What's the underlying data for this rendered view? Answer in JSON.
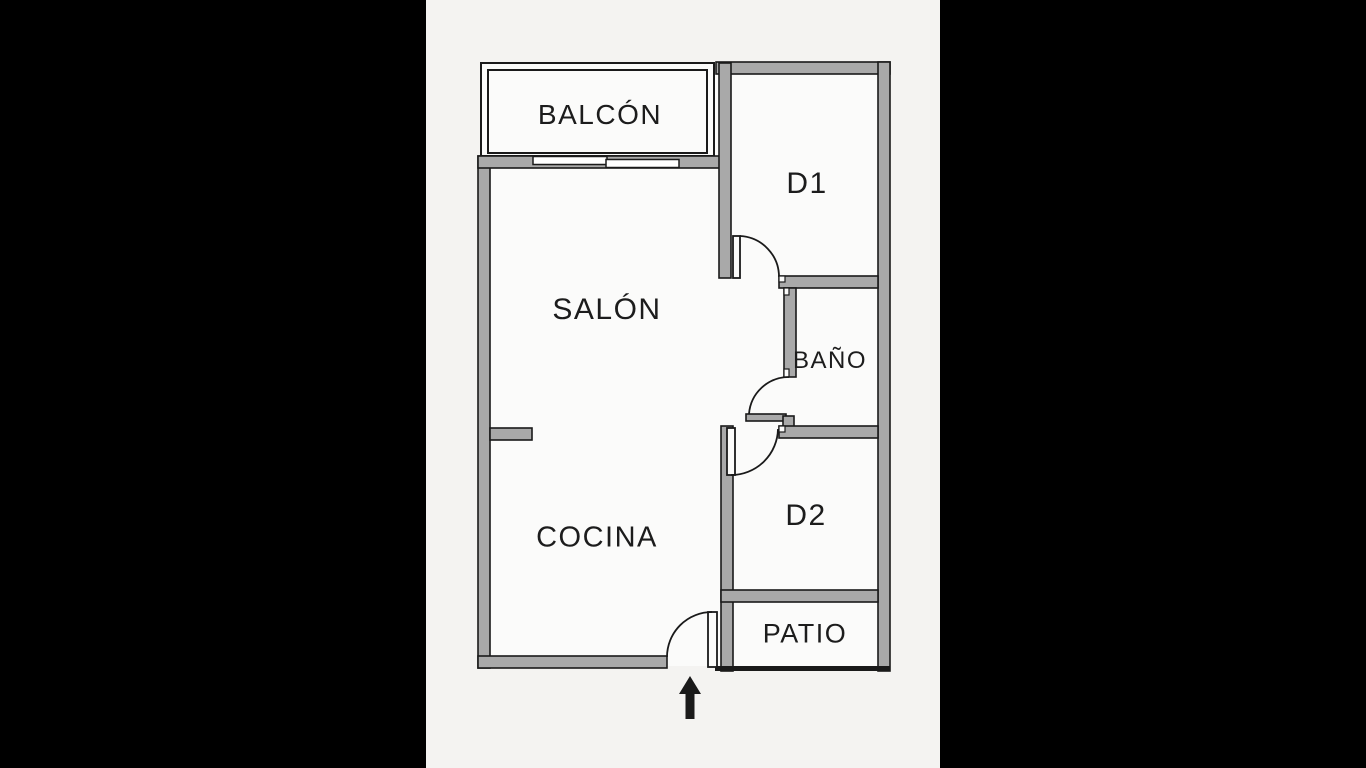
{
  "floor_plan": {
    "title": "Apartment floor plan",
    "rooms": [
      {
        "id": "balcon",
        "label": "BALCÓN"
      },
      {
        "id": "d1",
        "label": "D1"
      },
      {
        "id": "salon",
        "label": "SALÓN"
      },
      {
        "id": "bano",
        "label": "BAÑO"
      },
      {
        "id": "cocina",
        "label": "COCINA"
      },
      {
        "id": "d2",
        "label": "D2"
      },
      {
        "id": "patio",
        "label": "PATIO"
      }
    ],
    "entrance": {
      "direction": "up",
      "symbol": "arrow"
    },
    "features": [
      "entrance-door",
      "d1-door",
      "bano-door",
      "d2-door",
      "balcony-railing",
      "sliding-windows",
      "patio-edge"
    ],
    "colors": {
      "canvas": "#000000",
      "paper": "#f4f3f1",
      "room_fill": "#fbfbfa",
      "wall_fill": "#a9a9a9",
      "line": "#1a1a1a",
      "text": "#1c1c1c"
    }
  }
}
